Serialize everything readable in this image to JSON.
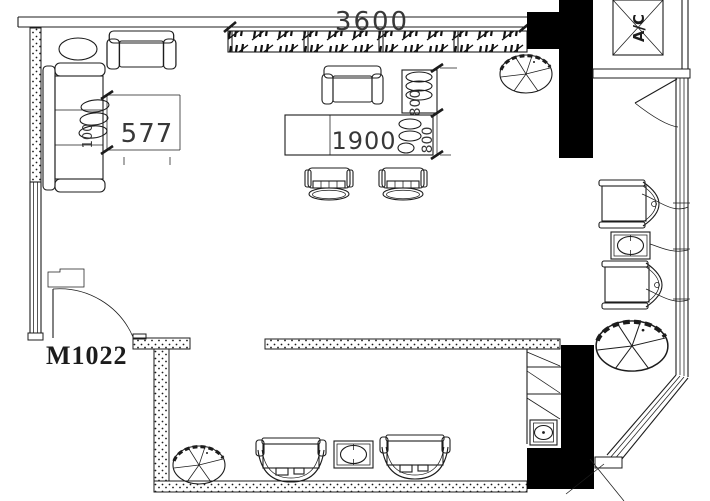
{
  "page": {
    "type": "cad-floor-plan",
    "colors": {
      "bg": "#ffffff",
      "ink": "#1c1c1c",
      "wall": "#000000",
      "dim": "#383838"
    }
  },
  "annotations": {
    "dim_top_wall": "3600",
    "dim_console_table": "1900",
    "dim_sofa_clearance": "577",
    "dim_bench_depth": "800",
    "dim_table_depth": "800",
    "dim_sofa_depth": "100",
    "door_code": "M1022",
    "ac_unit": "A/C"
  }
}
